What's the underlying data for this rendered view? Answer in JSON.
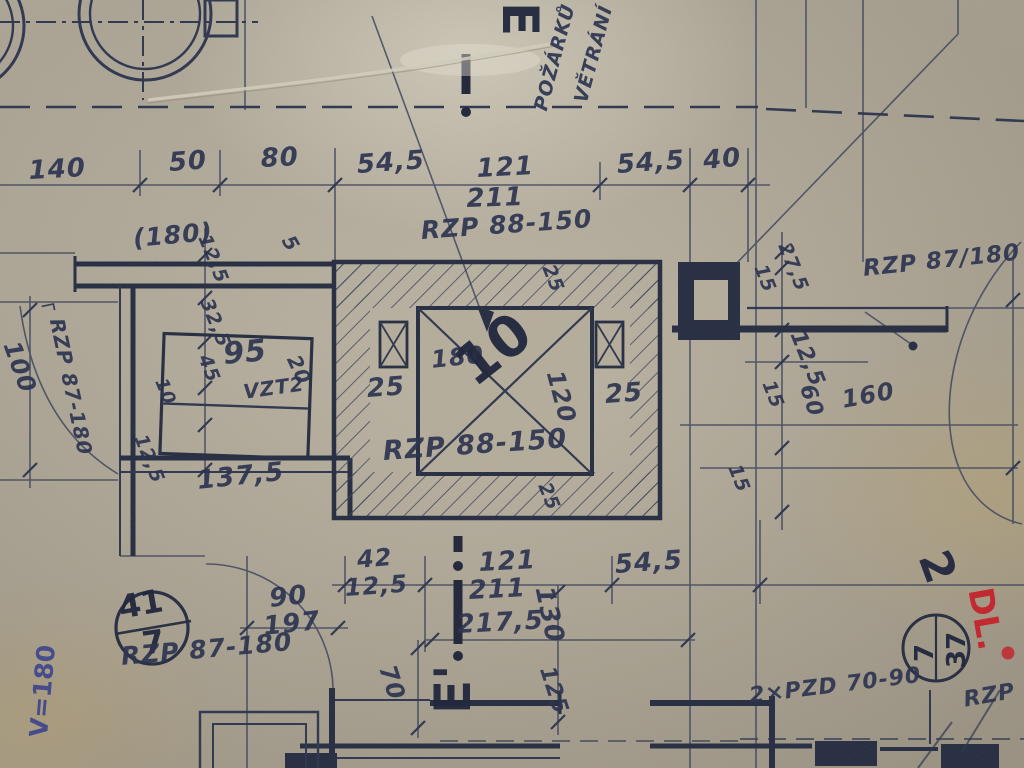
{
  "colors": {
    "paper": "#b6ae9c",
    "ink": "#39415c",
    "ink_bold": "#262d42",
    "red_pen": "#c4232b",
    "blue_pen": "#353e8d"
  },
  "section_markers": {
    "top": "E",
    "bottom": "E'"
  },
  "room_stamps": [
    {
      "number": "41",
      "floor": "7"
    },
    {
      "number": "37",
      "floor": "7"
    }
  ],
  "labels": [
    {
      "name": "section-marker-e-top",
      "text": "E",
      "x": 545,
      "y": 2,
      "rot": 90,
      "size": 50,
      "cls": "hand"
    },
    {
      "name": "note-vetrani",
      "text": "VĚTRÁNÍ",
      "x": 572,
      "y": 100,
      "rot": -75,
      "size": 19
    },
    {
      "name": "note-pozarku",
      "text": "POŽÁRKŮ",
      "x": 532,
      "y": 108,
      "rot": -75,
      "size": 19
    },
    {
      "name": "dim-140",
      "text": "140",
      "x": 28,
      "y": 158,
      "rot": -3,
      "size": 26
    },
    {
      "name": "dim-50",
      "text": "50",
      "x": 168,
      "y": 150,
      "rot": -4,
      "size": 26
    },
    {
      "name": "dim-80",
      "text": "80",
      "x": 260,
      "y": 146,
      "rot": -3,
      "size": 26
    },
    {
      "name": "dim-545-top-left",
      "text": "54,5",
      "x": 356,
      "y": 152,
      "rot": -4,
      "size": 26
    },
    {
      "name": "dim-121-top",
      "text": "121",
      "x": 476,
      "y": 156,
      "rot": -3,
      "size": 26
    },
    {
      "name": "dim-211-top",
      "text": "211",
      "x": 466,
      "y": 186,
      "rot": -2,
      "size": 26
    },
    {
      "name": "label-rzp-88-150-top",
      "text": "RZP 88-150",
      "x": 420,
      "y": 218,
      "rot": -4,
      "size": 25
    },
    {
      "name": "dim-545-top-right",
      "text": "54,5",
      "x": 616,
      "y": 152,
      "rot": -4,
      "size": 26
    },
    {
      "name": "dim-40",
      "text": "40",
      "x": 702,
      "y": 148,
      "rot": -5,
      "size": 26
    },
    {
      "name": "dim-180-paren",
      "text": "(180)",
      "x": 132,
      "y": 226,
      "rot": -5,
      "size": 25
    },
    {
      "name": "dim-125-left-top",
      "text": "12,5",
      "x": 212,
      "y": 232,
      "rot": 68,
      "size": 19
    },
    {
      "name": "dim-5",
      "text": "5",
      "x": 296,
      "y": 232,
      "rot": 60,
      "size": 20
    },
    {
      "name": "dim-325-left",
      "text": "32,5",
      "x": 214,
      "y": 296,
      "rot": 68,
      "size": 19
    },
    {
      "name": "dim-45-left",
      "text": "45",
      "x": 212,
      "y": 352,
      "rot": 68,
      "size": 19
    },
    {
      "name": "dim-95",
      "text": "95",
      "x": 222,
      "y": 340,
      "rot": -5,
      "size": 30
    },
    {
      "name": "dim-10-small",
      "text": "10",
      "x": 168,
      "y": 376,
      "rot": 68,
      "size": 18
    },
    {
      "name": "label-vzt",
      "text": "VZT2",
      "x": 242,
      "y": 382,
      "rot": -8,
      "size": 20
    },
    {
      "name": "dim-20",
      "text": "20",
      "x": 302,
      "y": 352,
      "rot": 65,
      "size": 20
    },
    {
      "name": "dim-100",
      "text": "100",
      "x": 22,
      "y": 338,
      "rot": 70,
      "size": 24
    },
    {
      "name": "label-rzp-87-180-left",
      "text": "┌ RZP 87-180",
      "x": 62,
      "y": 296,
      "rot": 78,
      "size": 20
    },
    {
      "name": "dim-125-left-mid",
      "text": "12,5",
      "x": 148,
      "y": 432,
      "rot": 68,
      "size": 19
    },
    {
      "name": "dim-1375",
      "text": "137,5",
      "x": 196,
      "y": 468,
      "rot": -6,
      "size": 26,
      "cls": "lbl bold7"
    },
    {
      "name": "dim-25-left",
      "text": "25",
      "x": 366,
      "y": 376,
      "rot": -4,
      "size": 26
    },
    {
      "name": "dim-180-box",
      "text": "180",
      "x": 430,
      "y": 348,
      "rot": -6,
      "size": 24
    },
    {
      "name": "num-10-big",
      "text": "10",
      "x": 446,
      "y": 352,
      "rot": -38,
      "size": 56,
      "cls": "hand"
    },
    {
      "name": "dim-120-box",
      "text": "120",
      "x": 566,
      "y": 368,
      "rot": 75,
      "size": 24
    },
    {
      "name": "dim-25-right",
      "text": "25",
      "x": 604,
      "y": 382,
      "rot": -4,
      "size": 26
    },
    {
      "name": "label-rzp-88-150-box",
      "text": "RZP 88-150",
      "x": 382,
      "y": 438,
      "rot": -4,
      "size": 27
    },
    {
      "name": "dim-25-top",
      "text": "25",
      "x": 556,
      "y": 262,
      "rot": 68,
      "size": 19
    },
    {
      "name": "dim-25-bottom",
      "text": "25",
      "x": 552,
      "y": 480,
      "rot": 68,
      "size": 19
    },
    {
      "name": "dim-275-right",
      "text": "27,5",
      "x": 792,
      "y": 240,
      "rot": 68,
      "size": 19
    },
    {
      "name": "dim-15-right-1",
      "text": "15",
      "x": 768,
      "y": 262,
      "rot": 68,
      "size": 19
    },
    {
      "name": "label-rzp-87-180-right",
      "text": "RZP 87/180",
      "x": 862,
      "y": 258,
      "rot": -6,
      "size": 23
    },
    {
      "name": "dim-125-right",
      "text": "12,5",
      "x": 806,
      "y": 328,
      "rot": 68,
      "size": 22
    },
    {
      "name": "dim-15-right-2",
      "text": "15",
      "x": 776,
      "y": 378,
      "rot": 68,
      "size": 19
    },
    {
      "name": "dim-60-right",
      "text": "60",
      "x": 816,
      "y": 382,
      "rot": 72,
      "size": 22
    },
    {
      "name": "dim-160-right",
      "text": "160",
      "x": 840,
      "y": 388,
      "rot": -10,
      "size": 24
    },
    {
      "name": "dim-15-right-3",
      "text": "15",
      "x": 742,
      "y": 462,
      "rot": 68,
      "size": 19
    },
    {
      "name": "num-2-hand",
      "text": "2",
      "x": 952,
      "y": 545,
      "rot": 70,
      "size": 44,
      "cls": "hand"
    },
    {
      "name": "note-dl-red",
      "text": "DL.",
      "x": 996,
      "y": 585,
      "rot": 80,
      "size": 34,
      "cls": "hand red"
    },
    {
      "name": "room-37",
      "text": "37",
      "x": 944,
      "y": 668,
      "rot": -90,
      "size": 26,
      "cls": "hand"
    },
    {
      "name": "room-37-floor",
      "text": "7",
      "x": 912,
      "y": 662,
      "rot": -90,
      "size": 26,
      "cls": "hand"
    },
    {
      "name": "room-41",
      "text": "41",
      "x": 116,
      "y": 592,
      "rot": -10,
      "size": 32,
      "cls": "hand"
    },
    {
      "name": "room-41-floor",
      "text": "7",
      "x": 140,
      "y": 628,
      "rot": -8,
      "size": 32,
      "cls": "hand"
    },
    {
      "name": "label-rzp-87-180-bottom",
      "text": "RZP 87-180",
      "x": 120,
      "y": 644,
      "rot": -5,
      "size": 25
    },
    {
      "name": "dim-90",
      "text": "90",
      "x": 268,
      "y": 586,
      "rot": -6,
      "size": 26
    },
    {
      "name": "dim-197",
      "text": "197",
      "x": 262,
      "y": 614,
      "rot": -6,
      "size": 26
    },
    {
      "name": "dim-42",
      "text": "42",
      "x": 356,
      "y": 548,
      "rot": -5,
      "size": 24
    },
    {
      "name": "dim-125-bottom-left",
      "text": "12,5",
      "x": 344,
      "y": 576,
      "rot": -4,
      "size": 24
    },
    {
      "name": "dim-121-bottom",
      "text": "121",
      "x": 478,
      "y": 550,
      "rot": -3,
      "size": 26
    },
    {
      "name": "dim-211-bottom",
      "text": "211",
      "x": 468,
      "y": 578,
      "rot": -3,
      "size": 26
    },
    {
      "name": "dim-2175",
      "text": "217,5",
      "x": 456,
      "y": 612,
      "rot": -3,
      "size": 26
    },
    {
      "name": "dim-130",
      "text": "130",
      "x": 556,
      "y": 584,
      "rot": 78,
      "size": 26
    },
    {
      "name": "dim-545-bottom",
      "text": "54,5",
      "x": 614,
      "y": 552,
      "rot": -4,
      "size": 26
    },
    {
      "name": "dim-70",
      "text": "70",
      "x": 398,
      "y": 662,
      "rot": 72,
      "size": 24
    },
    {
      "name": "section-marker-e-bottom",
      "text": "E'",
      "x": 428,
      "y": 714,
      "rot": -90,
      "size": 50,
      "cls": "hand"
    },
    {
      "name": "dim-125-bottom-mid",
      "text": "125",
      "x": 556,
      "y": 664,
      "rot": 72,
      "size": 22
    },
    {
      "name": "label-2xpzd",
      "text": "2×PZD 70-90",
      "x": 748,
      "y": 686,
      "rot": -7,
      "size": 22
    },
    {
      "name": "label-rzp-bottom-right",
      "text": "RZP",
      "x": 962,
      "y": 690,
      "rot": -10,
      "size": 22
    },
    {
      "name": "note-v180-blue",
      "text": "V=180",
      "x": 26,
      "y": 736,
      "rot": -85,
      "size": 25,
      "cls": "pen"
    }
  ]
}
